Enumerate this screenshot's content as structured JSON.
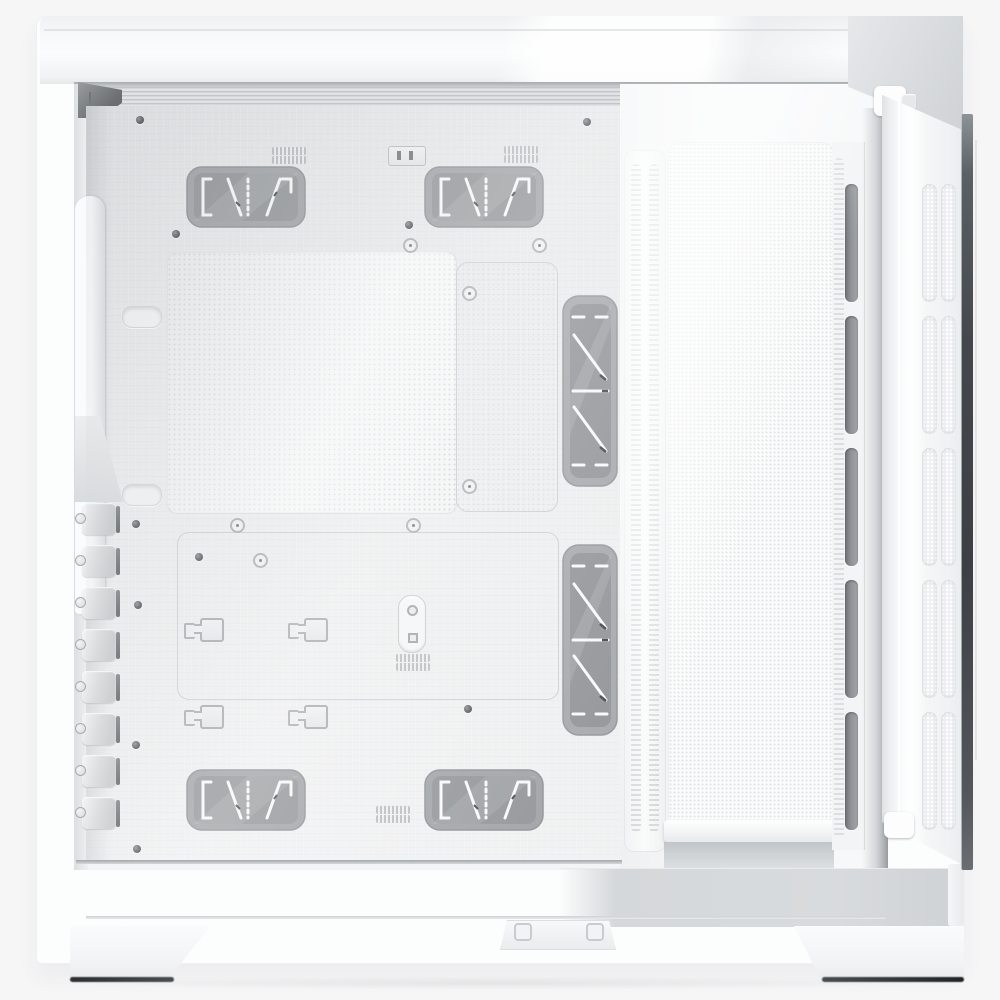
{
  "scene": {
    "type": "product-photo",
    "subject": "White dual-chamber ATX mid-tower PC case, left-side interior view with the tempered-glass side door swung open",
    "orientation": "side view, empty interior, door hinged at the right edge",
    "background_color": "#f6f6f7"
  },
  "palette": {
    "case_white": "#fbfcfd",
    "top_face": "#f3f4f5",
    "tray_gray": "#e9ebec",
    "mesh_square": "#eff1f2",
    "chamber_mesh_white": "#fafbfb",
    "grommet_fill": "#8f9295",
    "grommet_rim": "#8b8e91",
    "rubber_finger_white": "#f7f8f9",
    "vent_slot_dark": "#6e7175",
    "door_white": "#f6f7f8",
    "glass_edge_dark": "#43474c",
    "sill_gray": "#d6d9db",
    "foot_edge_dark": "#2b2d2f"
  },
  "parts": {
    "case_body": "case body",
    "top_panel": "top panel",
    "interior": "main chamber interior",
    "ceiling_rail": "top fan and radiator rail",
    "motherboard_tray": "motherboard tray",
    "mesh_vent": "perforated vent area",
    "cable_grommet": "rubber cable grommet",
    "standoff_area": "motherboard standoff area",
    "cable_clip": "cable-tie anchor",
    "screw": "screw",
    "pci_slots": "PCI expansion slot covers",
    "chamber_divider": "chamber divider rail",
    "rear_mesh": "rear chamber mesh panel",
    "vent_rail": "vent rail",
    "glass_door": "tempered-glass side door",
    "door_hinge": "door hinge",
    "glass_edge": "glass door edge",
    "bottom_sill": "bottom chamber sill",
    "bottom_latch": "bottom panel latch",
    "case_foot": "case foot"
  }
}
